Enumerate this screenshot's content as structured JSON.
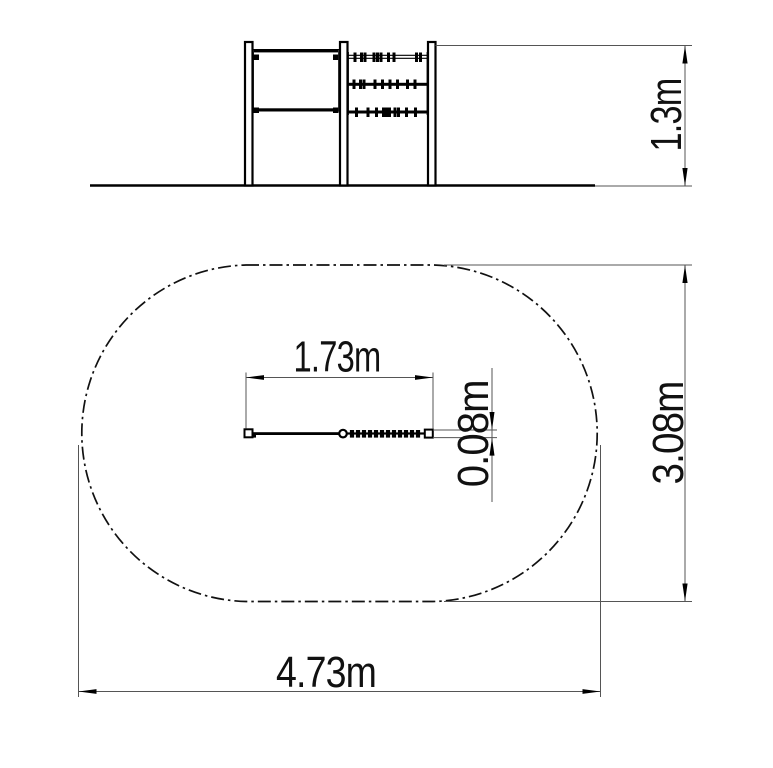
{
  "background": "#ffffff",
  "line_color": "#000000",
  "thin_line_color": "#555555",
  "views": {
    "side_elevation": {
      "description_items": [],
      "height_dimension": {
        "label": "1.3m",
        "orientation": "vertical"
      }
    },
    "plan": {
      "equipment_length_dimension": {
        "label": "1.73m",
        "orientation": "horizontal"
      },
      "equipment_width_dimension": {
        "label": "0.08m",
        "orientation": "vertical"
      },
      "safety_zone_depth_dimension": {
        "label": "3.08m",
        "orientation": "vertical"
      },
      "safety_zone_length_dimension": {
        "label": "4.73m",
        "orientation": "horizontal"
      }
    }
  }
}
